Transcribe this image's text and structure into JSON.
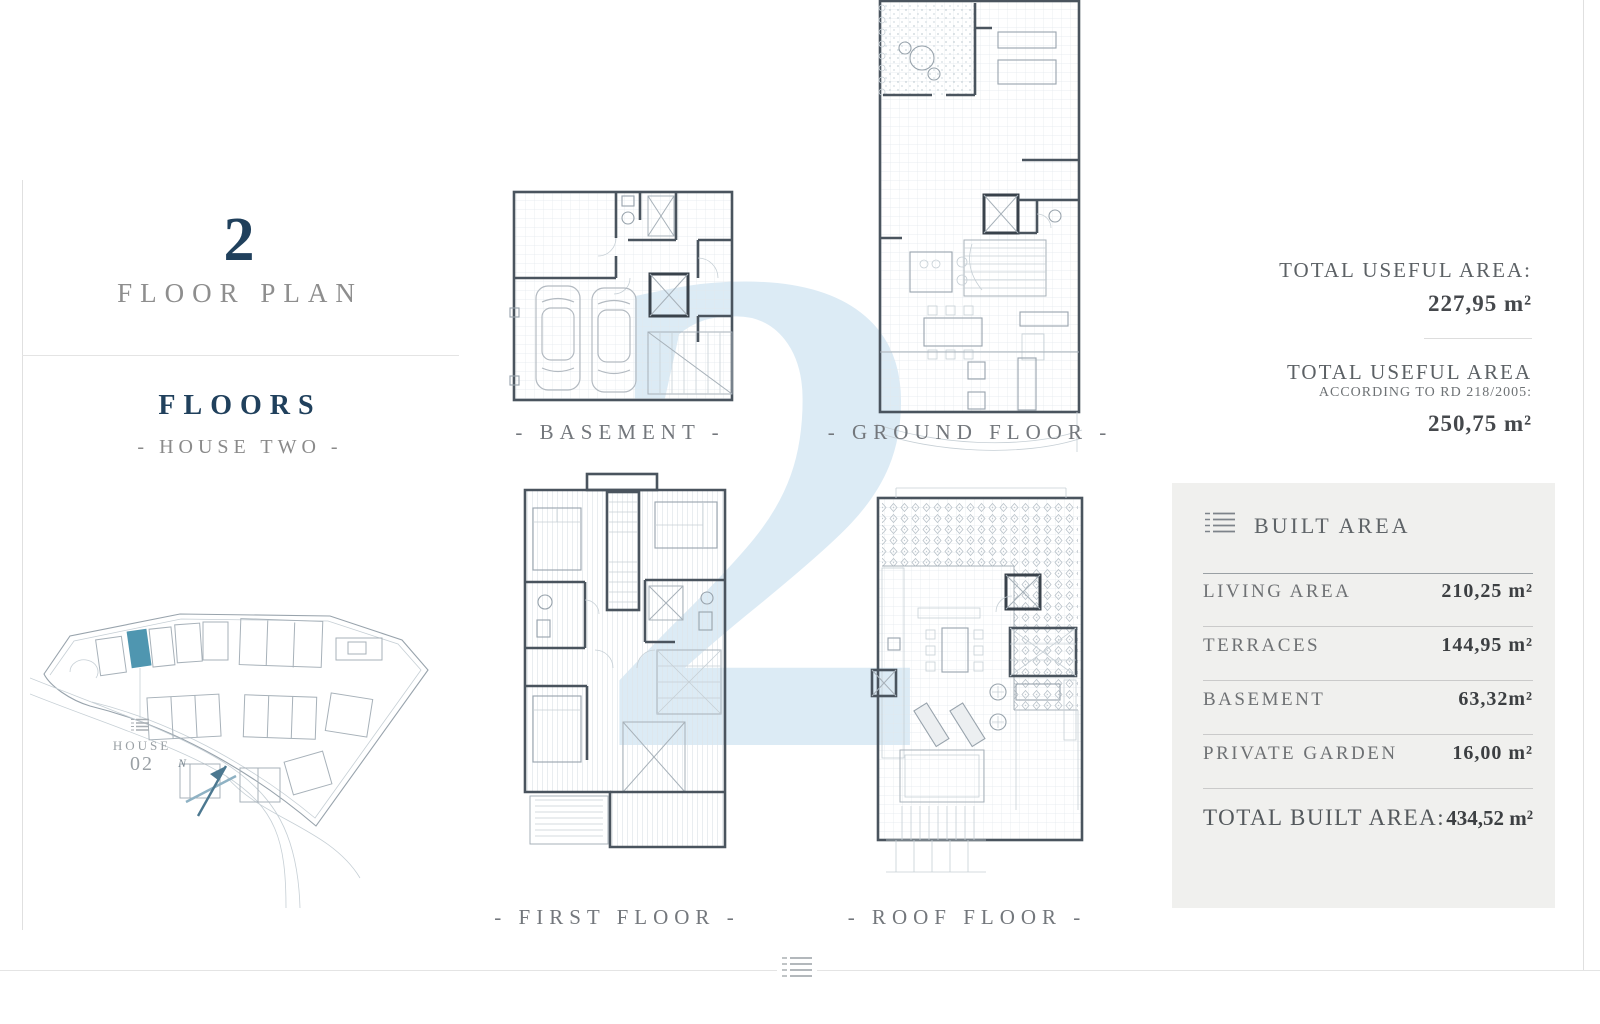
{
  "watermark": {
    "numeral": "2"
  },
  "title_block": {
    "number": "2",
    "subtitle": "FLOOR PLAN"
  },
  "section": {
    "title": "FLOORS",
    "subtitle": "- HOUSE TWO -"
  },
  "site_plan": {
    "house_label": "HOUSE",
    "house_number": "02",
    "compass": "N",
    "highlight_color": "#4f96b0"
  },
  "plans": [
    {
      "id": "basement",
      "label": "- BASEMENT -"
    },
    {
      "id": "ground-floor",
      "label": "- GROUND FLOOR -"
    },
    {
      "id": "first-floor",
      "label": "- FIRST FLOOR -"
    },
    {
      "id": "roof-floor",
      "label": "- ROOF FLOOR -"
    }
  ],
  "useful_area": {
    "label1": "TOTAL USEFUL AREA:",
    "value1": "227,95  m²",
    "label2": "TOTAL USEFUL AREA",
    "sublabel2": "ACCORDING TO RD 218/2005:",
    "value2": "250,75  m²"
  },
  "built_area": {
    "title": "BUILT AREA",
    "rows": [
      {
        "label": "LIVING AREA",
        "value": "210,25 m²"
      },
      {
        "label": "TERRACES",
        "value": "144,95 m²"
      },
      {
        "label": "BASEMENT",
        "value": "63,32m²"
      },
      {
        "label": "PRIVATE GARDEN",
        "value": "16,00 m²"
      }
    ],
    "total_label": "TOTAL BUILT AREA:",
    "total_value": "434,52 m²"
  },
  "colors": {
    "accent_navy": "#20405c",
    "highlight_teal": "#4f96b0",
    "watermark_blue": "#dcebf5",
    "panel_bg": "#f0f0ee"
  }
}
